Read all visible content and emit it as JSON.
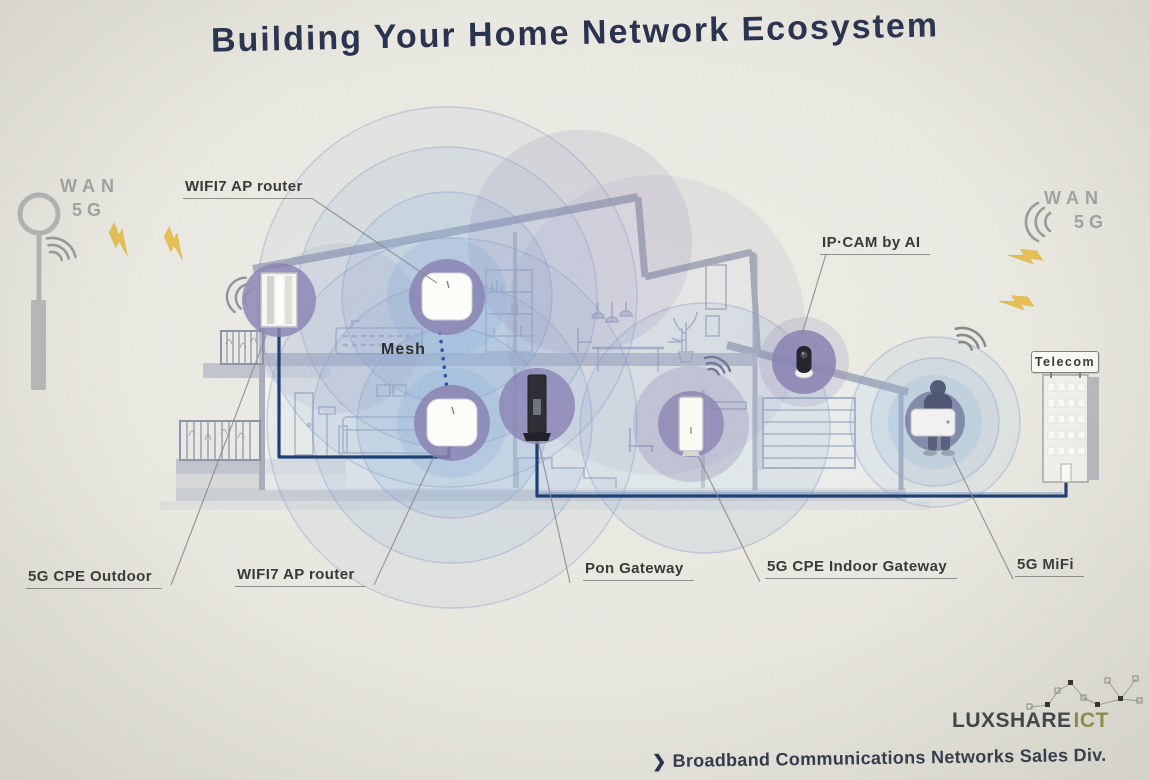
{
  "slide": {
    "title": "Building Your Home Network Ecosystem"
  },
  "wan": {
    "left": {
      "line1": "WAN",
      "line2": "5G"
    },
    "right": {
      "line1": "WAN",
      "line2": "5G"
    }
  },
  "device_labels": {
    "wifi7_ap_top": "WIFI7 AP router",
    "ip_cam": "IP·CAM by AI",
    "cpe_outdoor": "5G CPE Outdoor",
    "wifi7_ap_bottom": "WIFI7 AP router",
    "pon_gateway": "Pon Gateway",
    "cpe_indoor": "5G CPE Indoor Gateway",
    "mifi": "5G MiFi",
    "mesh": "Mesh",
    "telecom_sign": "Telecom"
  },
  "footer": {
    "brand_primary": "LUXSHARE",
    "brand_secondary": "ICT",
    "bullet": "❯",
    "division": "Broadband Communications Networks Sales Div."
  },
  "colors": {
    "title": "#28324f",
    "paper": "#e8e7df",
    "cable": "#1d3e73",
    "wifi_blue": "#8fb4da",
    "device_purple": "#8a84b4",
    "lightning": "#e6c055",
    "label_text": "#383838",
    "wan_text": "#a3a3a3",
    "brand_primary": "#3e4246",
    "brand_secondary": "#8e9147",
    "division_text": "#2e3849"
  }
}
